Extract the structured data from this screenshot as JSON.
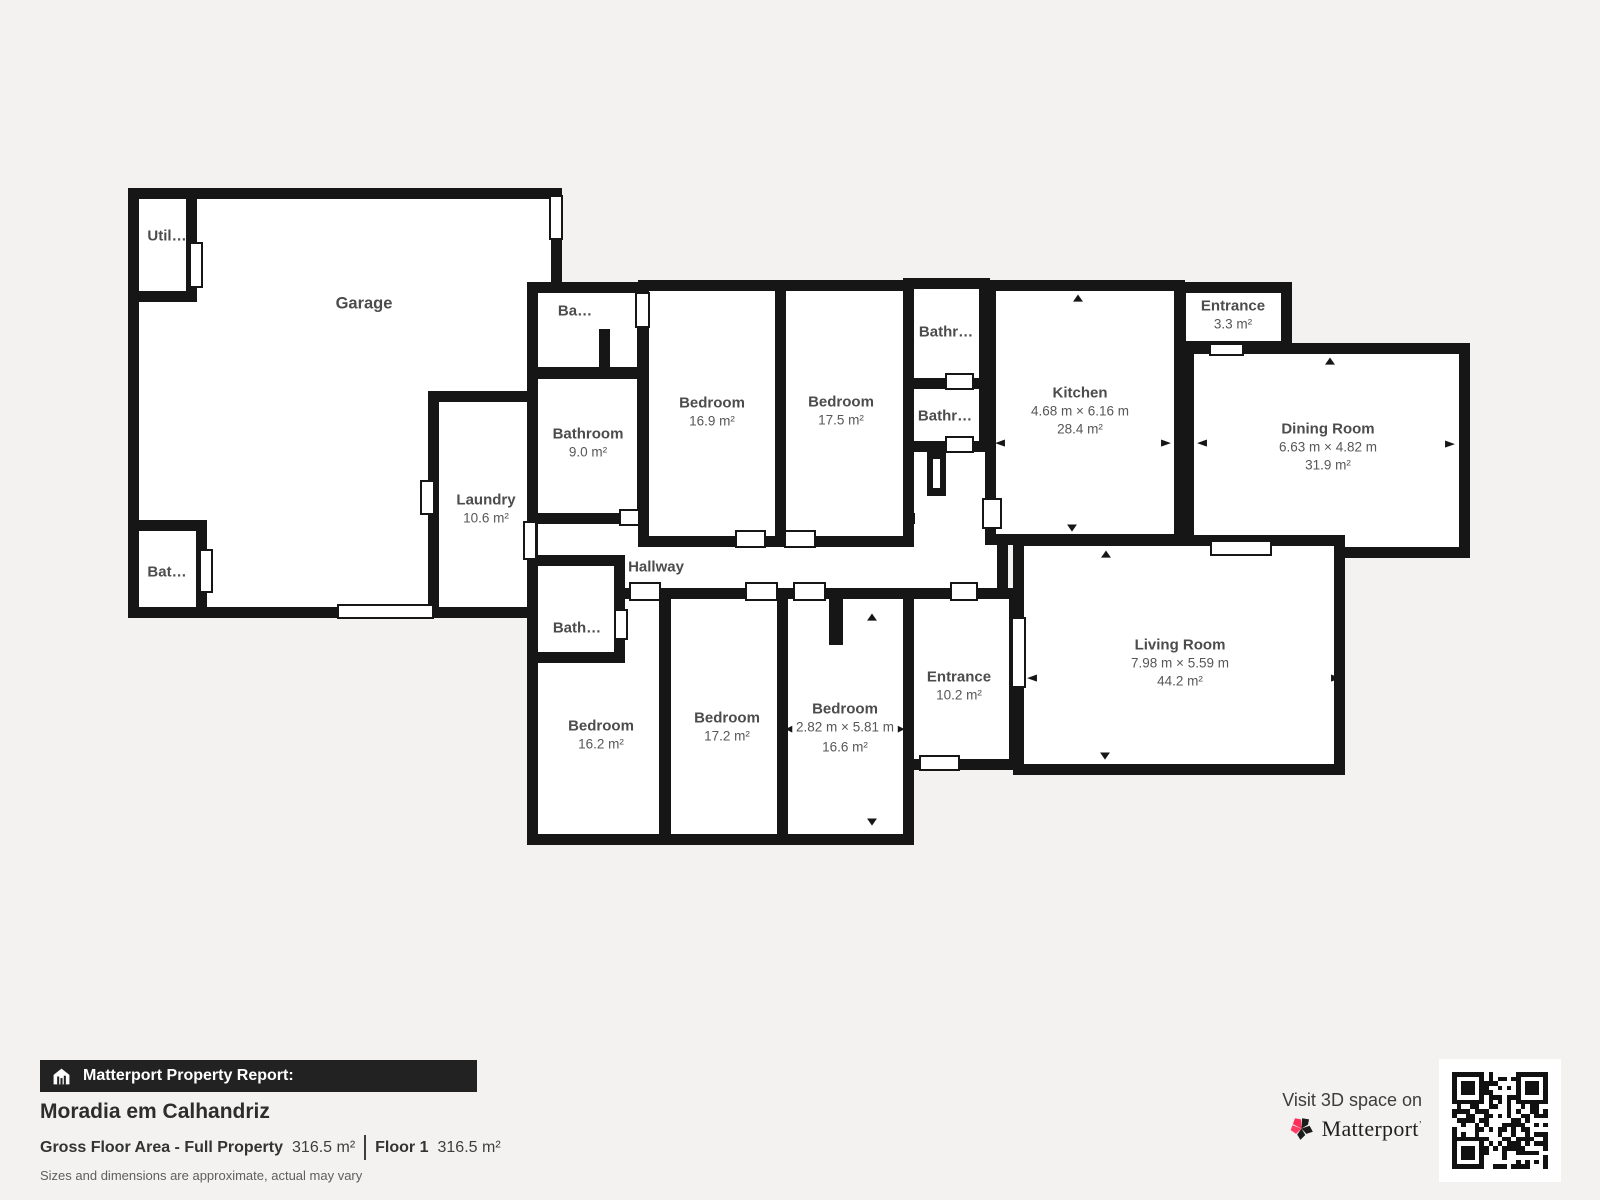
{
  "icons": {
    "arrow_up": "▲",
    "arrow_down": "▼",
    "arrow_left": "◀",
    "arrow_right": "▶"
  },
  "plan": {
    "rooms": {
      "garage": {
        "name": "Garage"
      },
      "utility": {
        "name": "Util…"
      },
      "garage_bathroom": {
        "name": "Bat…"
      },
      "laundry": {
        "name": "Laundry",
        "area": "10.6 m²"
      },
      "small_room_top": {
        "name": "Ba…"
      },
      "bathroom_main": {
        "name": "Bathroom",
        "area": "9.0 m²"
      },
      "bedroom_1": {
        "name": "Bedroom",
        "area": "16.9 m²"
      },
      "bedroom_2": {
        "name": "Bedroom",
        "area": "17.5 m²"
      },
      "bathroom_top": {
        "name": "Bathr…"
      },
      "bathroom_mid": {
        "name": "Bathr…"
      },
      "kitchen": {
        "name": "Kitchen",
        "dims": "4.68 m × 6.16 m",
        "area": "28.4 m²"
      },
      "entrance_top": {
        "name": "Entrance",
        "area": "3.3 m²"
      },
      "dining_room": {
        "name": "Dining Room",
        "dims": "6.63 m × 4.82 m",
        "area": "31.9 m²"
      },
      "hallway": {
        "name": "Hallway"
      },
      "bathroom_hall": {
        "name": "Bath…"
      },
      "bedroom_3": {
        "name": "Bedroom",
        "area": "16.2 m²"
      },
      "bedroom_4": {
        "name": "Bedroom",
        "area": "17.2 m²"
      },
      "bedroom_5": {
        "name": "Bedroom",
        "dims": "2.82 m × 5.81 m",
        "area": "16.6 m²"
      },
      "entrance_main": {
        "name": "Entrance",
        "area": "10.2 m²"
      },
      "living_room": {
        "name": "Living Room",
        "dims": "7.98 m × 5.59 m",
        "area": "44.2 m²"
      }
    }
  },
  "report": {
    "bar_title": "Matterport Property Report:",
    "property_name": "Moradia em Calhandriz",
    "gfa_label": "Gross Floor Area - Full Property",
    "gfa_value": "316.5 m²",
    "floor_label": "Floor 1",
    "floor_value": "316.5 m²",
    "disclaimer": "Sizes and dimensions are approximate, actual may vary"
  },
  "branding": {
    "visit_text": "Visit 3D space on",
    "brand_name": "Matterport",
    "trademark": "’"
  },
  "colors": {
    "wall": "#161616",
    "room_fill": "#ffffff",
    "background": "#f3f2f0",
    "brand_pink": "#ff2d57"
  }
}
